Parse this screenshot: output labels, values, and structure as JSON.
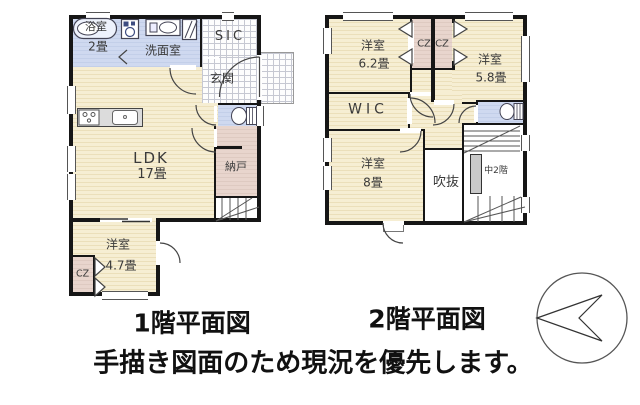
{
  "floor1": {
    "caption": "1階平面図",
    "labels": {
      "bath": "浴室",
      "bath_size": "2畳",
      "washroom": "洗面室",
      "shoe_closet": "SIC",
      "entrance": "玄関",
      "ldk": "LDK",
      "ldk_size": "17畳",
      "storage": "納戸",
      "bedroom": "洋室",
      "bedroom_size": "4.7畳",
      "closet": "CZ"
    }
  },
  "floor2": {
    "caption": "2階平面図",
    "labels": {
      "bedroom_a": "洋室",
      "bedroom_a_size": "6.2畳",
      "closet_left": "CZ",
      "closet_right": "CZ",
      "bedroom_b": "洋室",
      "bedroom_b_size": "5.8畳",
      "wic": "WIC",
      "bedroom_c": "洋室",
      "bedroom_c_size": "8畳",
      "void": "吹抜",
      "mezzanine": "中2階"
    }
  },
  "note": "手描き図面のため現況を優先します。",
  "icons": {
    "bathtub": "bathtub-icon",
    "washing_machine": "washing-machine-icon",
    "vanity": "vanity-sink-icon",
    "window": "window-icon",
    "toilet": "toilet-icon",
    "stove": "kitchen-stove-icon",
    "sink": "kitchen-sink-icon",
    "folding_door": "folding-door-icon",
    "compass": "compass-north-icon"
  },
  "colors": {
    "wall": "#161616",
    "room_cream": "#f4ebcd",
    "wet_area_blue": "#ccd7ef",
    "closet_pink": "#e6d3cb",
    "void_white": "#ffffff",
    "hatch_line": "#c6c8d2",
    "stair_gray": "#c9c9c9"
  }
}
